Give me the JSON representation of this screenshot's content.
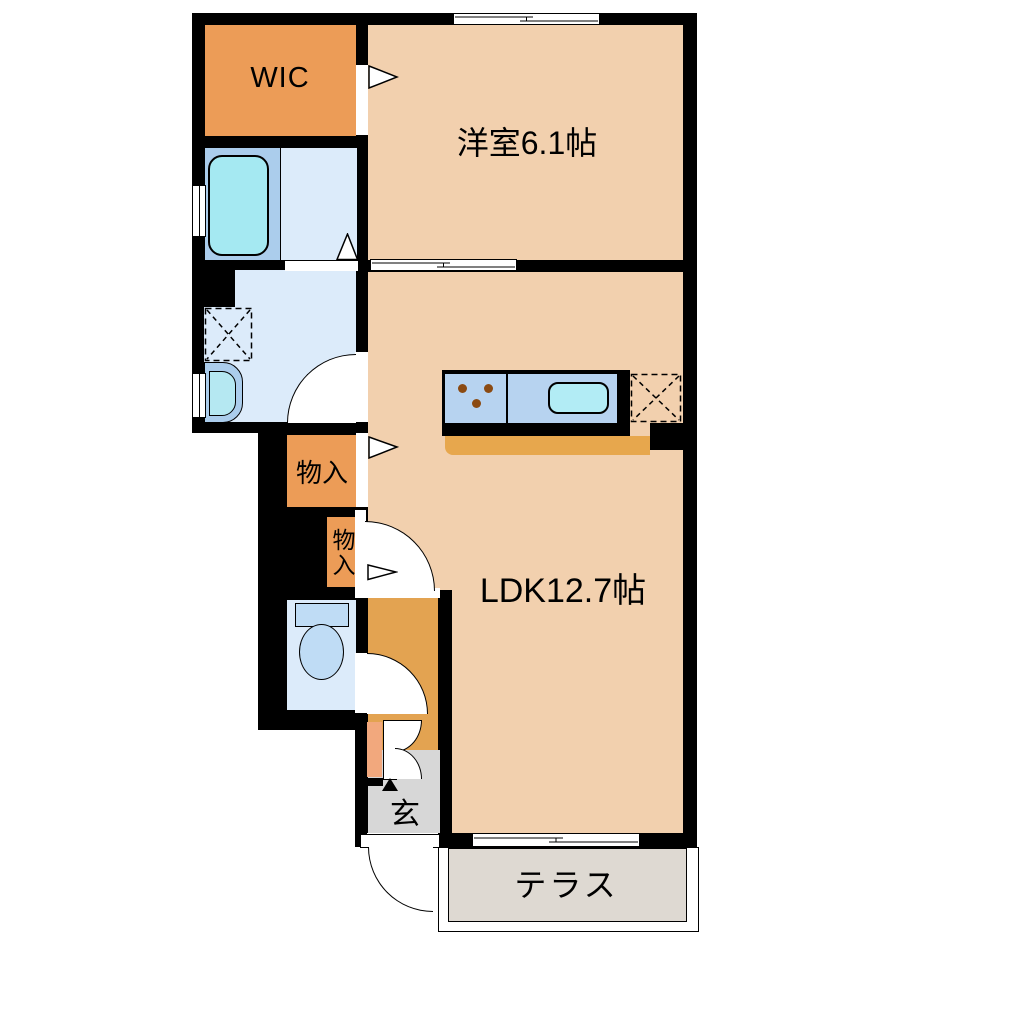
{
  "title": "1LDK apartment floor plan",
  "labels": {
    "wic": "WIC",
    "western_room": "洋室6.1帖",
    "ldk": "LDK12.7帖",
    "storage_1": "物入",
    "storage_2": "物入",
    "entrance": "玄",
    "terrace": "テラス"
  },
  "colors": {
    "wall": "#000000",
    "background": "#FFFFFF",
    "room-peach": "#F2D0AE",
    "room-orange": "#EC9C57",
    "hall-orange": "#E3A351",
    "entry-salmon": "#F2A87D",
    "bath-blue": "#ABCDEC",
    "wet-blue": "#DCEBFA",
    "tub-cyan": "#A5E9F2",
    "basin-cyan": "#B5E8F2",
    "sink-cyan": "#B2ECF5",
    "counter-blue": "#B7D3F0",
    "counter-bar": "#E7A74D",
    "toilet-fixture": "#BFDCF5",
    "genkan-gray": "#D7D7D7",
    "terrace-gray": "#DED9D2",
    "burner-brown": "#8B4A12"
  }
}
